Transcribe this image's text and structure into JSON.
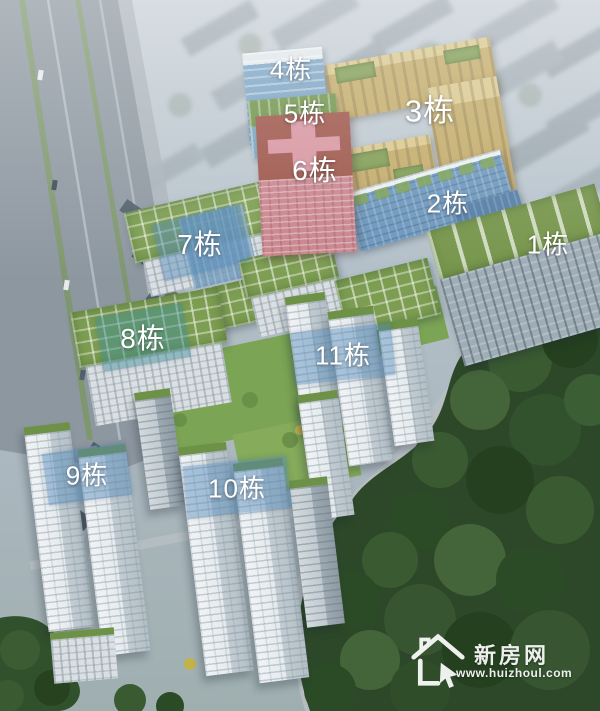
{
  "labels": {
    "b1": "1栋",
    "b2": "2栋",
    "b3": "3栋",
    "b4": "4栋",
    "b5": "5栋",
    "b6": "6栋",
    "b7": "7栋",
    "b8": "8栋",
    "b9": "9栋",
    "b10": "10栋",
    "b11": "11栋"
  },
  "watermark": {
    "site_name": "新房网",
    "site_url": "www.huizhoul.com",
    "icon": "house-icon"
  },
  "palette": {
    "building_2_highlight": "#6b96bc",
    "building_3_highlight": "#c2aa68",
    "building_4_highlight": "#7ba3c4",
    "building_5_highlight": "#7aa6c0",
    "building_6_highlight": "#c9858e",
    "label_panel_blue": "rgba(80,135,185,0.45)",
    "label_panel_teal": "rgba(60,140,150,0.45)",
    "label_text": "#ffffff",
    "green_roof": "#7d9e52",
    "forest": "#2d4829",
    "road": "#8d97a0",
    "sky_haze": "#b7c3cb"
  }
}
